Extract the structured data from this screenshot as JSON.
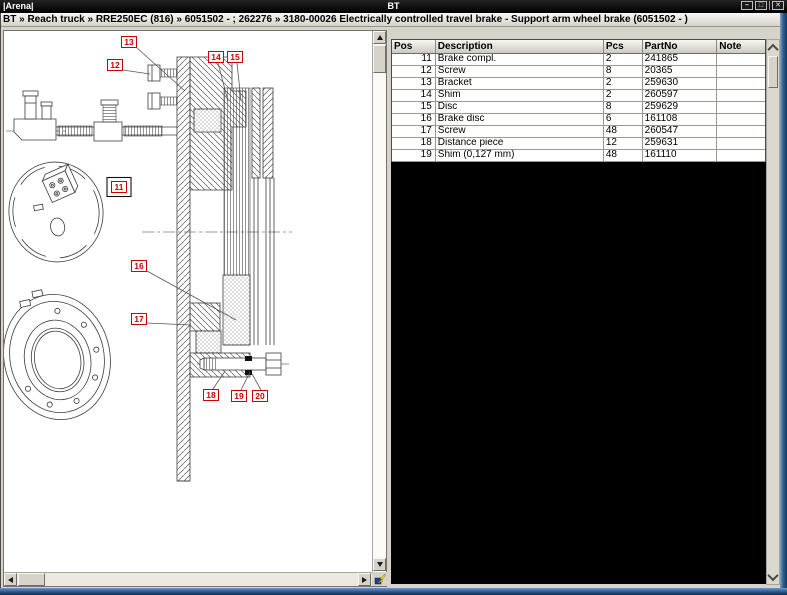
{
  "window": {
    "titlebar": {
      "app_label": "|Arena|",
      "center_title": "BT",
      "buttons": [
        {
          "name": "minimize",
          "glyph": "–"
        },
        {
          "name": "restore",
          "glyph": "□"
        },
        {
          "name": "close",
          "glyph": "✕"
        }
      ]
    },
    "breadcrumb": {
      "text": "BT » Reach truck » RRE250EC (816) » 6051502 - ; 262276 » 3180-00026 Electrically controlled travel brake - Support arm wheel brake (6051502 - )"
    }
  },
  "parts_table": {
    "columns": [
      {
        "key": "pos",
        "label": "Pos",
        "width": 44,
        "align": "right"
      },
      {
        "key": "description",
        "label": "Description",
        "width": 169,
        "align": "left"
      },
      {
        "key": "pcs",
        "label": "Pcs",
        "width": 39,
        "align": "left"
      },
      {
        "key": "partno",
        "label": "PartNo",
        "width": 75,
        "align": "left"
      },
      {
        "key": "note",
        "label": "Note",
        "width": 48,
        "align": "left"
      }
    ],
    "rows": [
      {
        "pos": "11",
        "description": "Brake compl.",
        "pcs": "2",
        "partno": "241865",
        "note": ""
      },
      {
        "pos": "12",
        "description": "Screw",
        "pcs": "8",
        "partno": "20365",
        "note": ""
      },
      {
        "pos": "13",
        "description": "Bracket",
        "pcs": "2",
        "partno": "259630",
        "note": ""
      },
      {
        "pos": "14",
        "description": "Shim",
        "pcs": "2",
        "partno": "260597",
        "note": ""
      },
      {
        "pos": "15",
        "description": "Disc",
        "pcs": "8",
        "partno": "259629",
        "note": ""
      },
      {
        "pos": "16",
        "description": "Brake disc",
        "pcs": "6",
        "partno": "161108",
        "note": ""
      },
      {
        "pos": "17",
        "description": "Screw",
        "pcs": "48",
        "partno": "260547",
        "note": ""
      },
      {
        "pos": "18",
        "description": "Distance piece",
        "pcs": "12",
        "partno": "259631",
        "note": ""
      },
      {
        "pos": "19",
        "description": "Shim (0,127 mm)",
        "pcs": "48",
        "partno": "161110",
        "note": ""
      },
      {
        "pos": "20",
        "description": "Shim (0,5 mm)",
        "pcs": "84",
        "partno": "178760",
        "note": ""
      }
    ]
  },
  "diagram": {
    "callout_color": "#cc0000",
    "callouts": [
      {
        "label": "11",
        "x": 115,
        "y": 156,
        "selected": true
      },
      {
        "label": "12",
        "x": 111,
        "y": 34,
        "leader": [
          119,
          39,
          146,
          43
        ]
      },
      {
        "label": "13",
        "x": 125,
        "y": 11,
        "leader": [
          133,
          17,
          181,
          60
        ]
      },
      {
        "label": "14",
        "x": 212,
        "y": 26,
        "leader": [
          214,
          32,
          224,
          70
        ]
      },
      {
        "label": "15",
        "x": 231,
        "y": 26,
        "leader": [
          233,
          32,
          237,
          70
        ]
      },
      {
        "label": "16",
        "x": 135,
        "y": 235,
        "leader": [
          143,
          240,
          232,
          289
        ]
      },
      {
        "label": "17",
        "x": 135,
        "y": 288,
        "leader": [
          143,
          292,
          187,
          294
        ]
      },
      {
        "label": "18",
        "x": 207,
        "y": 364,
        "leader": [
          209,
          358,
          221,
          340
        ]
      },
      {
        "label": "19",
        "x": 235,
        "y": 365,
        "leader": [
          237,
          359,
          246,
          341
        ]
      },
      {
        "label": "20",
        "x": 256,
        "y": 365,
        "leader": [
          257,
          359,
          248,
          343
        ]
      }
    ]
  },
  "icons": {
    "minimize": "minimize-icon",
    "restore": "restore-icon",
    "close": "close-icon",
    "scroll_up": "triangle-up",
    "scroll_down": "triangle-down",
    "scroll_left": "triangle-left",
    "scroll_right": "triangle-right",
    "table_scroll_up": "chevron-up",
    "table_scroll_down": "chevron-down",
    "corner_tool": "fit-drawing-tool"
  },
  "colors": {
    "titlebar_bg": "#000000",
    "panel_bg": "#d6d3ca",
    "callout_red": "#cc0000",
    "window_border_blue": "#2d5f95",
    "table_void": "#000000"
  }
}
